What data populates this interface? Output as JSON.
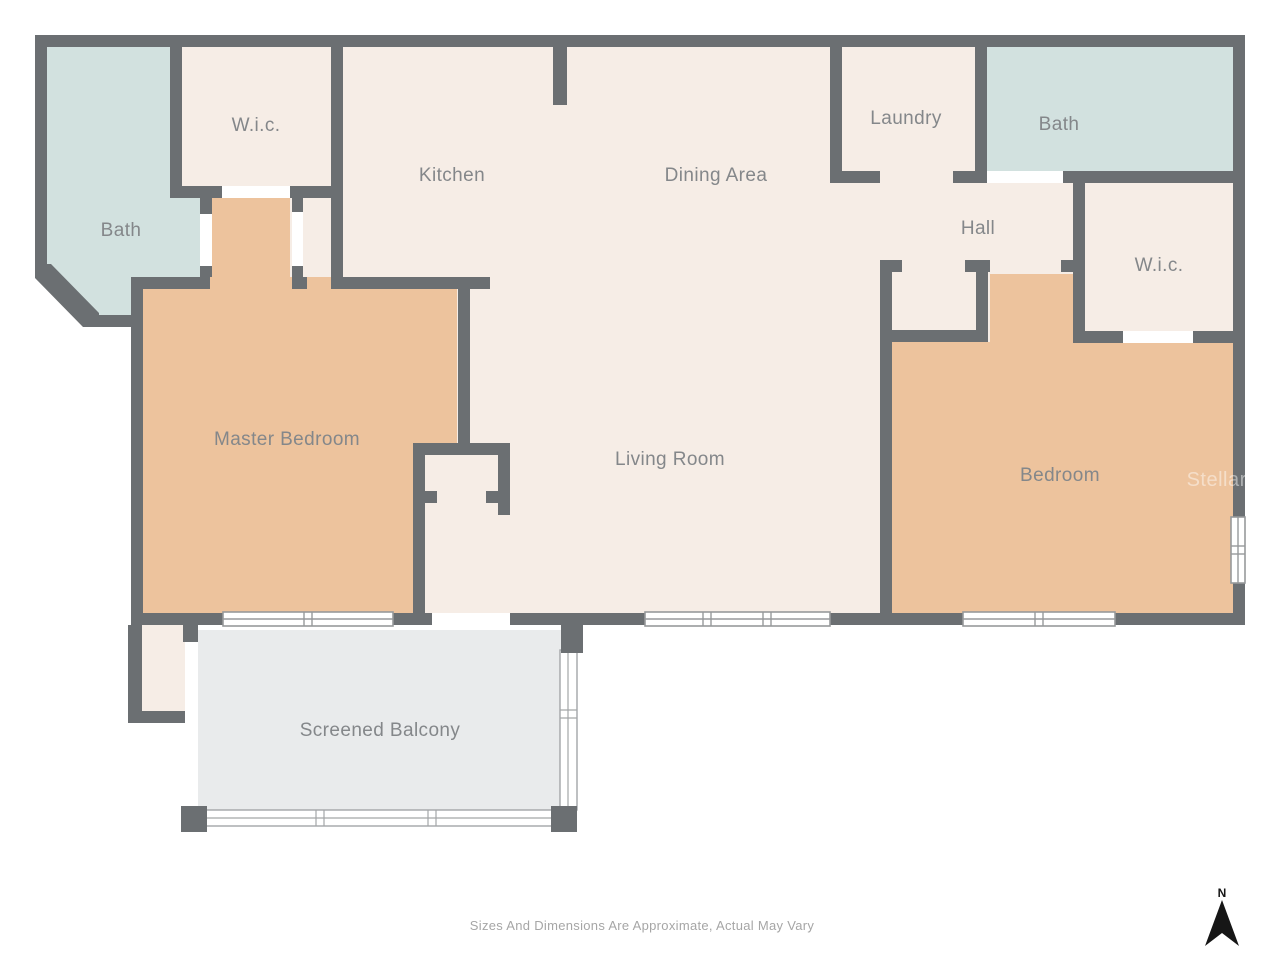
{
  "title": "Condominium Floor Plan",
  "colors": {
    "wall": "#6b6f72",
    "room_cream": "#f6ede6",
    "room_tan": "#edc39d",
    "room_teal": "#d2e1df",
    "balcony_gray": "#e9ebec",
    "label_gray": "#84878a",
    "disclaimer_gray": "#a6a6a6",
    "north_black": "#161616",
    "watermark_white": "#ffffff"
  },
  "rooms": {
    "bath_1": {
      "label": "Bath"
    },
    "wic_1": {
      "label": "W.i.c."
    },
    "kitchen": {
      "label": "Kitchen"
    },
    "dining": {
      "label": "Dining Area"
    },
    "laundry": {
      "label": "Laundry"
    },
    "bath_2": {
      "label": "Bath"
    },
    "hall": {
      "label": "Hall"
    },
    "wic_2": {
      "label": "W.i.c."
    },
    "master_bedroom": {
      "label": "Master Bedroom"
    },
    "living_room": {
      "label": "Living Room"
    },
    "bedroom": {
      "label": "Bedroom"
    },
    "screened_balcony": {
      "label": "Screened Balcony"
    }
  },
  "footer": {
    "disclaimer": "Sizes And Dimensions Are Approximate, Actual May Vary"
  },
  "compass": {
    "label": "N"
  },
  "watermark": {
    "text": "StellarMLS"
  }
}
